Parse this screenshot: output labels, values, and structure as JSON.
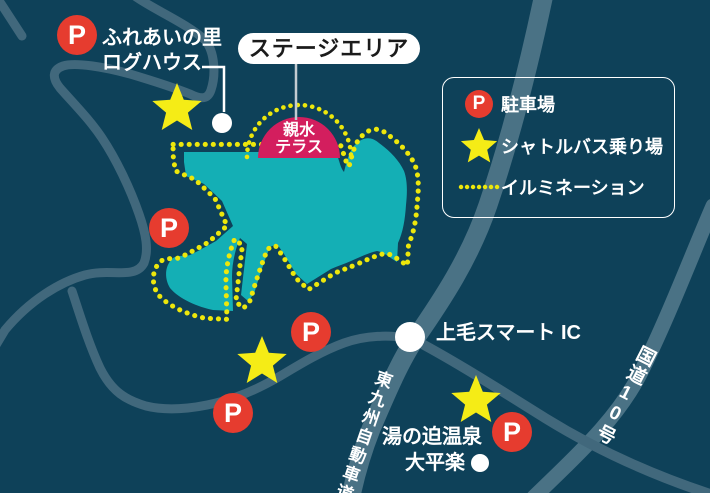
{
  "map": {
    "title": "イベント会場マップ",
    "colors": {
      "background": "#0E4159",
      "road": "#41687C",
      "road_major": "#4A7285",
      "water": "#14AFB5",
      "illumination": "#EDE70B",
      "star": "#F5EC16",
      "parking_red": "#E63C2F",
      "terrace_pink": "#D31E5E"
    },
    "labels": {
      "stage_area": "ステージエリア",
      "terrace_line1": "親水",
      "terrace_line2": "テラス",
      "fureai_line1": "ふれあいの里",
      "fureai_line2": "ログハウス",
      "smart_ic": "上毛スマート IC",
      "expressway": "東九州自動車道",
      "route10": "国道10号",
      "onsen_line1": "湯の迫温泉",
      "onsen_line2": "大平楽"
    },
    "legend": {
      "items": [
        {
          "symbol": "parking-icon",
          "label": "駐車場"
        },
        {
          "symbol": "shuttle-bus-star-icon",
          "label": "シャトルバス乗り場"
        },
        {
          "symbol": "illumination-dots-icon",
          "label": "イルミネーション"
        }
      ]
    },
    "markers": {
      "parking_letter": "P",
      "parking": [
        {
          "x": 77,
          "y": 35
        },
        {
          "x": 169,
          "y": 228
        },
        {
          "x": 311,
          "y": 332
        },
        {
          "x": 233,
          "y": 413
        },
        {
          "x": 512,
          "y": 432
        }
      ],
      "shuttle_stars": [
        {
          "x": 177,
          "y": 108
        },
        {
          "x": 262,
          "y": 361
        },
        {
          "x": 476,
          "y": 400
        }
      ],
      "points": [
        {
          "x": 222,
          "y": 123,
          "r": 10
        },
        {
          "x": 410,
          "y": 337,
          "r": 15
        },
        {
          "x": 480,
          "y": 463,
          "r": 9
        }
      ]
    }
  }
}
